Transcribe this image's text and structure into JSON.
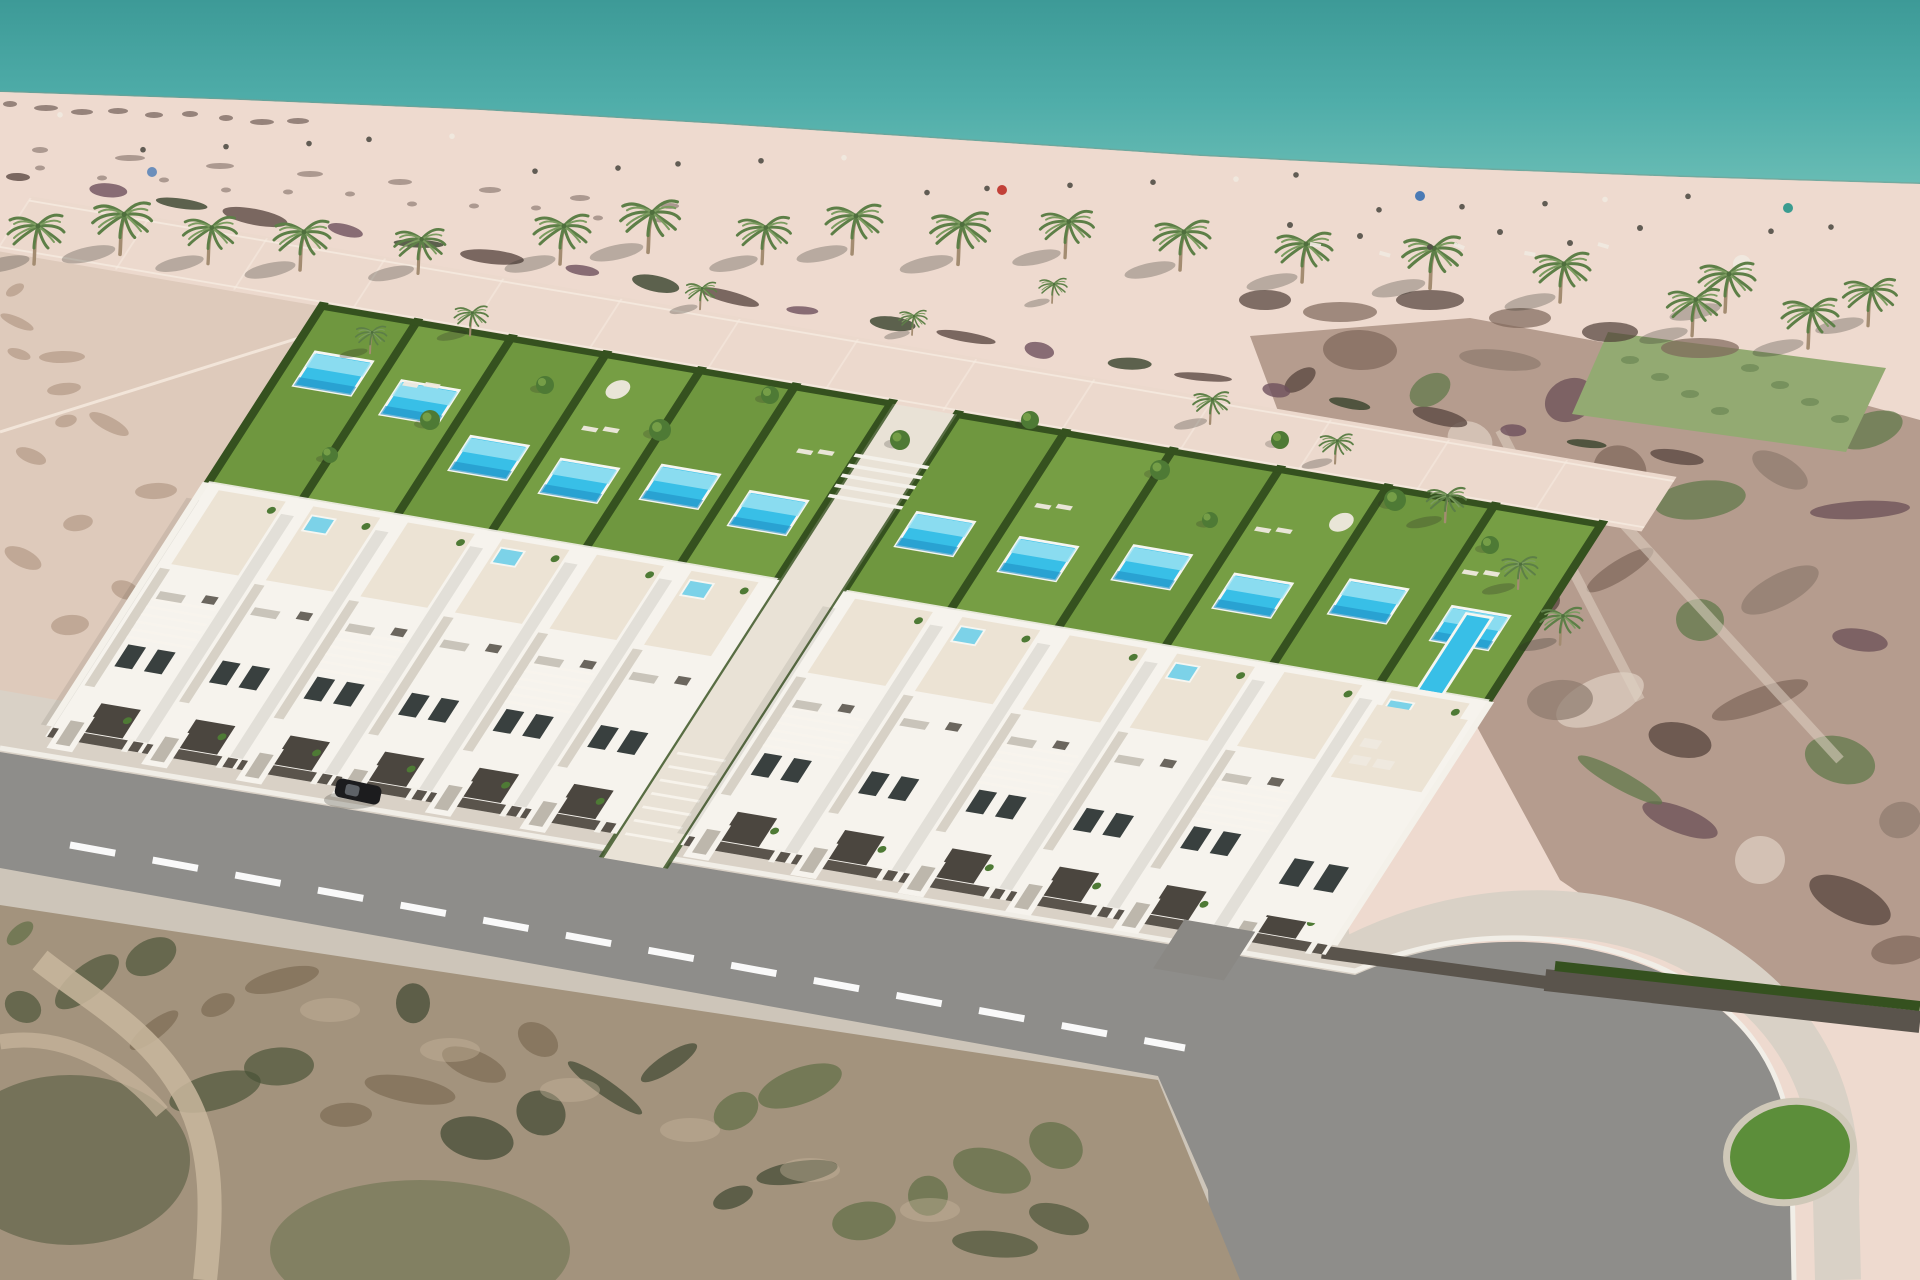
{
  "meta": {
    "description": "Aerial 3D architectural render of a beachfront development: two rows of modern white villas with private lawns and turquoise pools, a palm-lined sandy beach and teal sea above, an asphalt access road with dashed centerline and an oval green roundabout below, surrounded by undeveloped scrubland",
    "scene_type": "architectural-render"
  },
  "counts": {
    "villa_clusters": 2,
    "villa_units_visible": 12,
    "garden_pools": 12,
    "rooftop_spas": 7,
    "beach_palm_trees": 17,
    "roundabout_islands": 1
  },
  "colors": {
    "ocean_top": "#3d9a97",
    "ocean_mid": "#4fada9",
    "ocean_near": "#68bcb4",
    "waterline": "#7e9a8c",
    "wet_sand": "#d8c2b2",
    "beach": "#eedacf",
    "beach_far": "#e7d2c7",
    "promenade": "#ecd9cd",
    "prom_line": "#f7ece1",
    "sand_open": "#decabb",
    "sand_mottle": "#93755f",
    "debris": "#5c4a43",
    "debris_purple": "#6e505c",
    "lawn": "#6f973f",
    "lawn_light": "#7fa74c",
    "hedge": "#35511f",
    "tree_green": "#4e7a35",
    "palm_green": "#7c9c60",
    "palm_dark": "#5d7f47",
    "palm_trunk": "#a38c71",
    "pool": "#38bfe7",
    "pool_light": "#9fe4f2",
    "pool_deep": "#1f8fc5",
    "pool_rim": "#f6f6f1",
    "jacuzzi": "#7cd2e8",
    "villa": "#f6f3ed",
    "villa_shade": "#d7d1c6",
    "terrace": "#ece3d4",
    "terrace_line": "#f9f5ee",
    "window": "#39403f",
    "garage": "#4b463f",
    "fence": "#5a544c",
    "wall_white": "#f4f1ea",
    "road": "#8e8d8a",
    "sidewalk": "#d9d1c6",
    "sidewalk_low": "#cdc5b9",
    "curb": "#f1eee7",
    "dash": "#ffffff",
    "island": "#5c8e3a",
    "island_rim": "#cfc8b8",
    "scrub": "#a3937d",
    "scrub_d1": "#5a6b42",
    "scrub_d2": "#475236",
    "scrub_d3": "#7a6852",
    "scrub_d4": "#37422c",
    "path_dirt": "#c9b79e",
    "resort_base": "#b59c8e",
    "resort_d1": "#503f37",
    "resort_d2": "#7e675a",
    "resort_d3": "#5c7747",
    "resort_d4": "#8d7a6d",
    "resort_light": "#dfd2c4",
    "resort_purple": "#654a52",
    "lawn_patch": "#93aa72",
    "car": "#1c1c1e",
    "accent_red": "#c24038",
    "accent_blue": "#4a7ab5",
    "accent_teal": "#3a9c90",
    "people": "#514e46",
    "people_light": "#efe9df",
    "shadow": "#2e2e26"
  }
}
